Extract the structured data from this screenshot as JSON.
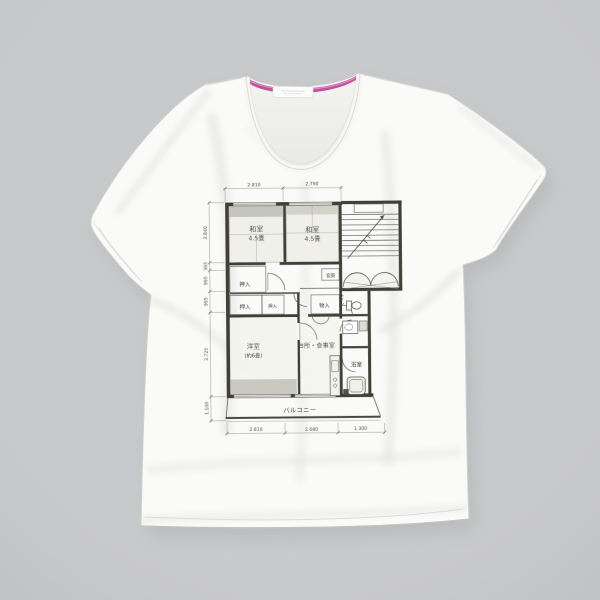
{
  "scene": {
    "background_color": "#c8c9ca",
    "shirt_color": "#fafaf9",
    "collar_tape_color": "#c2509e",
    "print_color": "#31312b"
  },
  "floorplan": {
    "rooms": {
      "waroom_left": {
        "name": "和室",
        "size": "4.5畳"
      },
      "waroom_right": {
        "name": "和室",
        "size": "4.5畳"
      },
      "western_room": {
        "name": "洋室",
        "size": "(約6畳)"
      },
      "kitchen_dining": {
        "name": "台所・食事室"
      },
      "bathroom": {
        "name": "浴室"
      },
      "entrance": {
        "name": "玄関"
      },
      "toilet": {
        "name": "トイレ"
      },
      "closet_upper": {
        "name": "押入"
      },
      "closet_lower_left": {
        "name": "押入"
      },
      "closet_lower_right": {
        "name": "押入"
      },
      "storage": {
        "name": "物入"
      },
      "balcony": {
        "name": "バルコニー"
      }
    },
    "dimensions": {
      "top": [
        "2.810",
        "2.790"
      ],
      "bottom": [
        "2.810",
        "2.680",
        "1.300"
      ],
      "left": [
        "2.840",
        "365",
        "995",
        "995",
        "3.725",
        "1.100"
      ]
    }
  }
}
